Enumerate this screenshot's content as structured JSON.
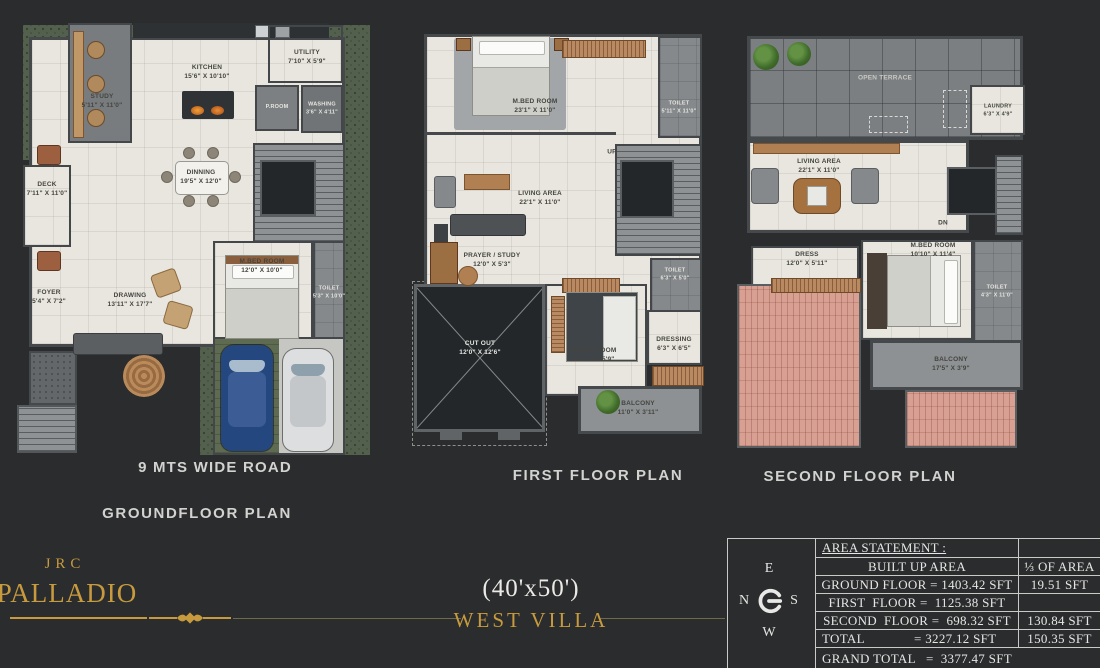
{
  "colors": {
    "gold": "#c79a3e",
    "background": "#2a2c2d",
    "floor_cream": "#e8e6df",
    "roof_pink": "#d7a093",
    "garden_green": "#53604e"
  },
  "branding": {
    "logo_top": "JRC",
    "logo_main": "PALLADIO",
    "plot_size": "(40'x50')",
    "villa_name": "WEST VILLA"
  },
  "compass": {
    "top": "E",
    "left": "N",
    "right": "S",
    "bottom": "W"
  },
  "area_table": {
    "title": "AREA STATEMENT :",
    "rows": [
      {
        "left": "BUILT UP AREA",
        "right": "⅓ OF AREA"
      },
      {
        "left": "GROUND FLOOR = 1403.42 SFT",
        "right": "19.51 SFT"
      },
      {
        "left": "FIRST  FLOOR =  1125.38 SFT",
        "right": ""
      },
      {
        "left": "SECOND  FLOOR =  698.32 SFT",
        "right": "130.84 SFT"
      },
      {
        "left": "TOTAL              = 3227.12 SFT",
        "right": "150.35 SFT"
      }
    ],
    "grand_total": "GRAND TOTAL   =  3377.47 SFT"
  },
  "plans": {
    "ground": {
      "title": "GROUNDFLOOR PLAN",
      "road": "9 MTS WIDE ROAD",
      "rooms": {
        "study": {
          "name": "STUDY",
          "dims": "5'11\" X 11'0\""
        },
        "kitchen": {
          "name": "KITCHEN",
          "dims": "15'6\" X 10'10\""
        },
        "utility": {
          "name": "UTILITY",
          "dims": "7'10\" X 5'9\""
        },
        "proom": {
          "name": "P.ROOM",
          "dims": ""
        },
        "washing": {
          "name": "WASHING",
          "dims": "3'6\" X 4'11\""
        },
        "deck": {
          "name": "DECK",
          "dims": "7'11\" X 11'0\""
        },
        "dinning": {
          "name": "DINNING",
          "dims": "19'5\" X 12'0\""
        },
        "mbed": {
          "name": "M.BED ROOM",
          "dims": "12'0\" X 10'0\""
        },
        "toilet": {
          "name": "TOILET",
          "dims": "5'3\" X 10'0\""
        },
        "foyer": {
          "name": "FOYER",
          "dims": "5'4\" X 7'2\""
        },
        "drawing": {
          "name": "DRAWING",
          "dims": "13'11\" X 17'7\""
        }
      }
    },
    "first": {
      "title": "FIRST FLOOR PLAN",
      "rooms": {
        "mbed1": {
          "name": "M.BED ROOM",
          "dims": "23'1\" X 11'0\""
        },
        "toilet1": {
          "name": "TOILET",
          "dims": "5'11\" X 11'0\""
        },
        "living": {
          "name": "LIVING AREA",
          "dims": "22'1\" X 11'0\""
        },
        "prayer": {
          "name": "PRAYER / STUDY",
          "dims": "12'0\" X 5'3\""
        },
        "toilet2": {
          "name": "TOILET",
          "dims": "6'3\" X 5'0\""
        },
        "cutout": {
          "name": "CUT OUT",
          "dims": "12'0\" X 12'6\""
        },
        "mbed2": {
          "name": "M.BED ROOM",
          "dims": "11'0\" X 15'9\""
        },
        "dressing": {
          "name": "DRESSING",
          "dims": "6'3\" X 6'5\""
        },
        "balcony": {
          "name": "BALCONY",
          "dims": "11'0\" X 3'11\""
        },
        "up": {
          "name": "UP",
          "dims": ""
        }
      }
    },
    "second": {
      "title": "SECOND FLOOR PLAN",
      "rooms": {
        "terrace": {
          "name": "OPEN TERRACE",
          "dims": ""
        },
        "laundry": {
          "name": "LAUNDRY",
          "dims": "6'3\" X 4'9\""
        },
        "living": {
          "name": "LIVING AREA",
          "dims": "22'1\" X 11'0\""
        },
        "dress": {
          "name": "DRESS",
          "dims": "12'0\" X 5'11\""
        },
        "mbed": {
          "name": "M.BED ROOM",
          "dims": "10'10\" X 11'4\""
        },
        "toilet": {
          "name": "TOILET",
          "dims": "4'3\" X 11'0\""
        },
        "balcony": {
          "name": "BALCONY",
          "dims": "17'5\" X 3'9\""
        },
        "dn": {
          "name": "DN",
          "dims": ""
        }
      }
    }
  }
}
